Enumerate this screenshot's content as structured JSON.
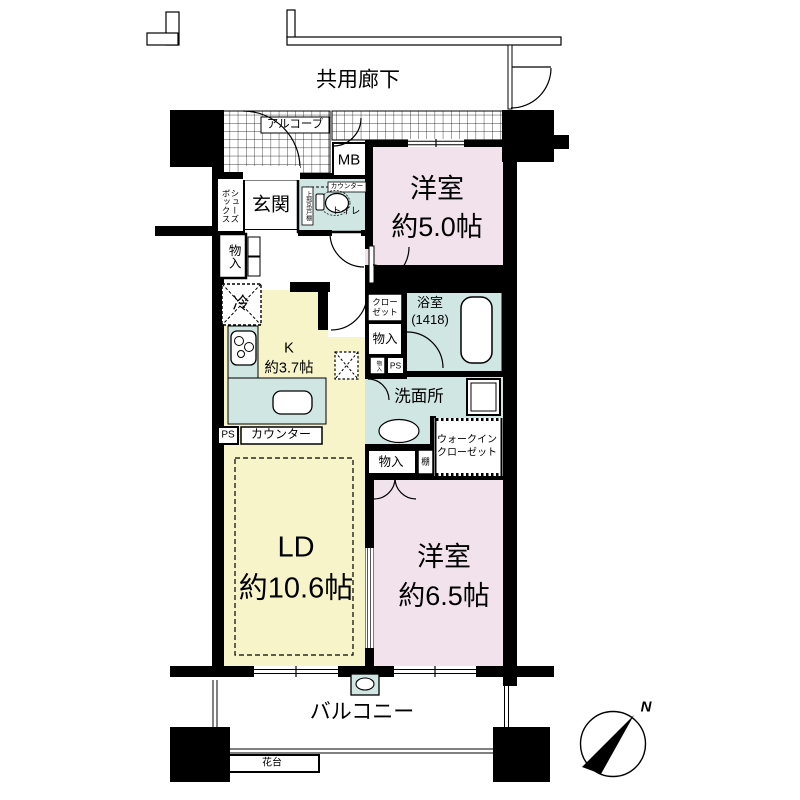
{
  "colors": {
    "pink": "#f2e2ec",
    "yellow": "#f6f4c8",
    "teal": "#cfe6e2",
    "wall": "#000000"
  },
  "exterior": {
    "corridor": "共用廊下",
    "alcove": "アルコーブ",
    "meter_box": "MB",
    "balcony": "バルコニー",
    "flower_stand": "花台",
    "compass_north": "N"
  },
  "entrance": {
    "genkan": "玄関",
    "shoe_box": "シューズ\nボックス",
    "storage": "物入"
  },
  "toilet": {
    "label": "トイレ",
    "counter": "カウンター",
    "upper_cabinet": "上部吊戸棚"
  },
  "kitchen": {
    "label": "K\n約3.7帖",
    "fridge": "冷",
    "ps": "PS",
    "counter": "カウンター"
  },
  "hall": {
    "closet": "クロー\nゼット",
    "storage": "物入",
    "storage_small": "物入",
    "ps": "PS"
  },
  "bathroom": {
    "label": "浴室\n(1418)"
  },
  "washroom": {
    "label": "洗面所"
  },
  "wic": {
    "label": "ウォークイン\nクローゼット",
    "storage": "物入",
    "shelf": "棚"
  },
  "rooms": {
    "bedroom1": "洋室\n約5.0帖",
    "bedroom2": "洋室\n約6.5帖",
    "living": "LD\n約10.6帖"
  }
}
